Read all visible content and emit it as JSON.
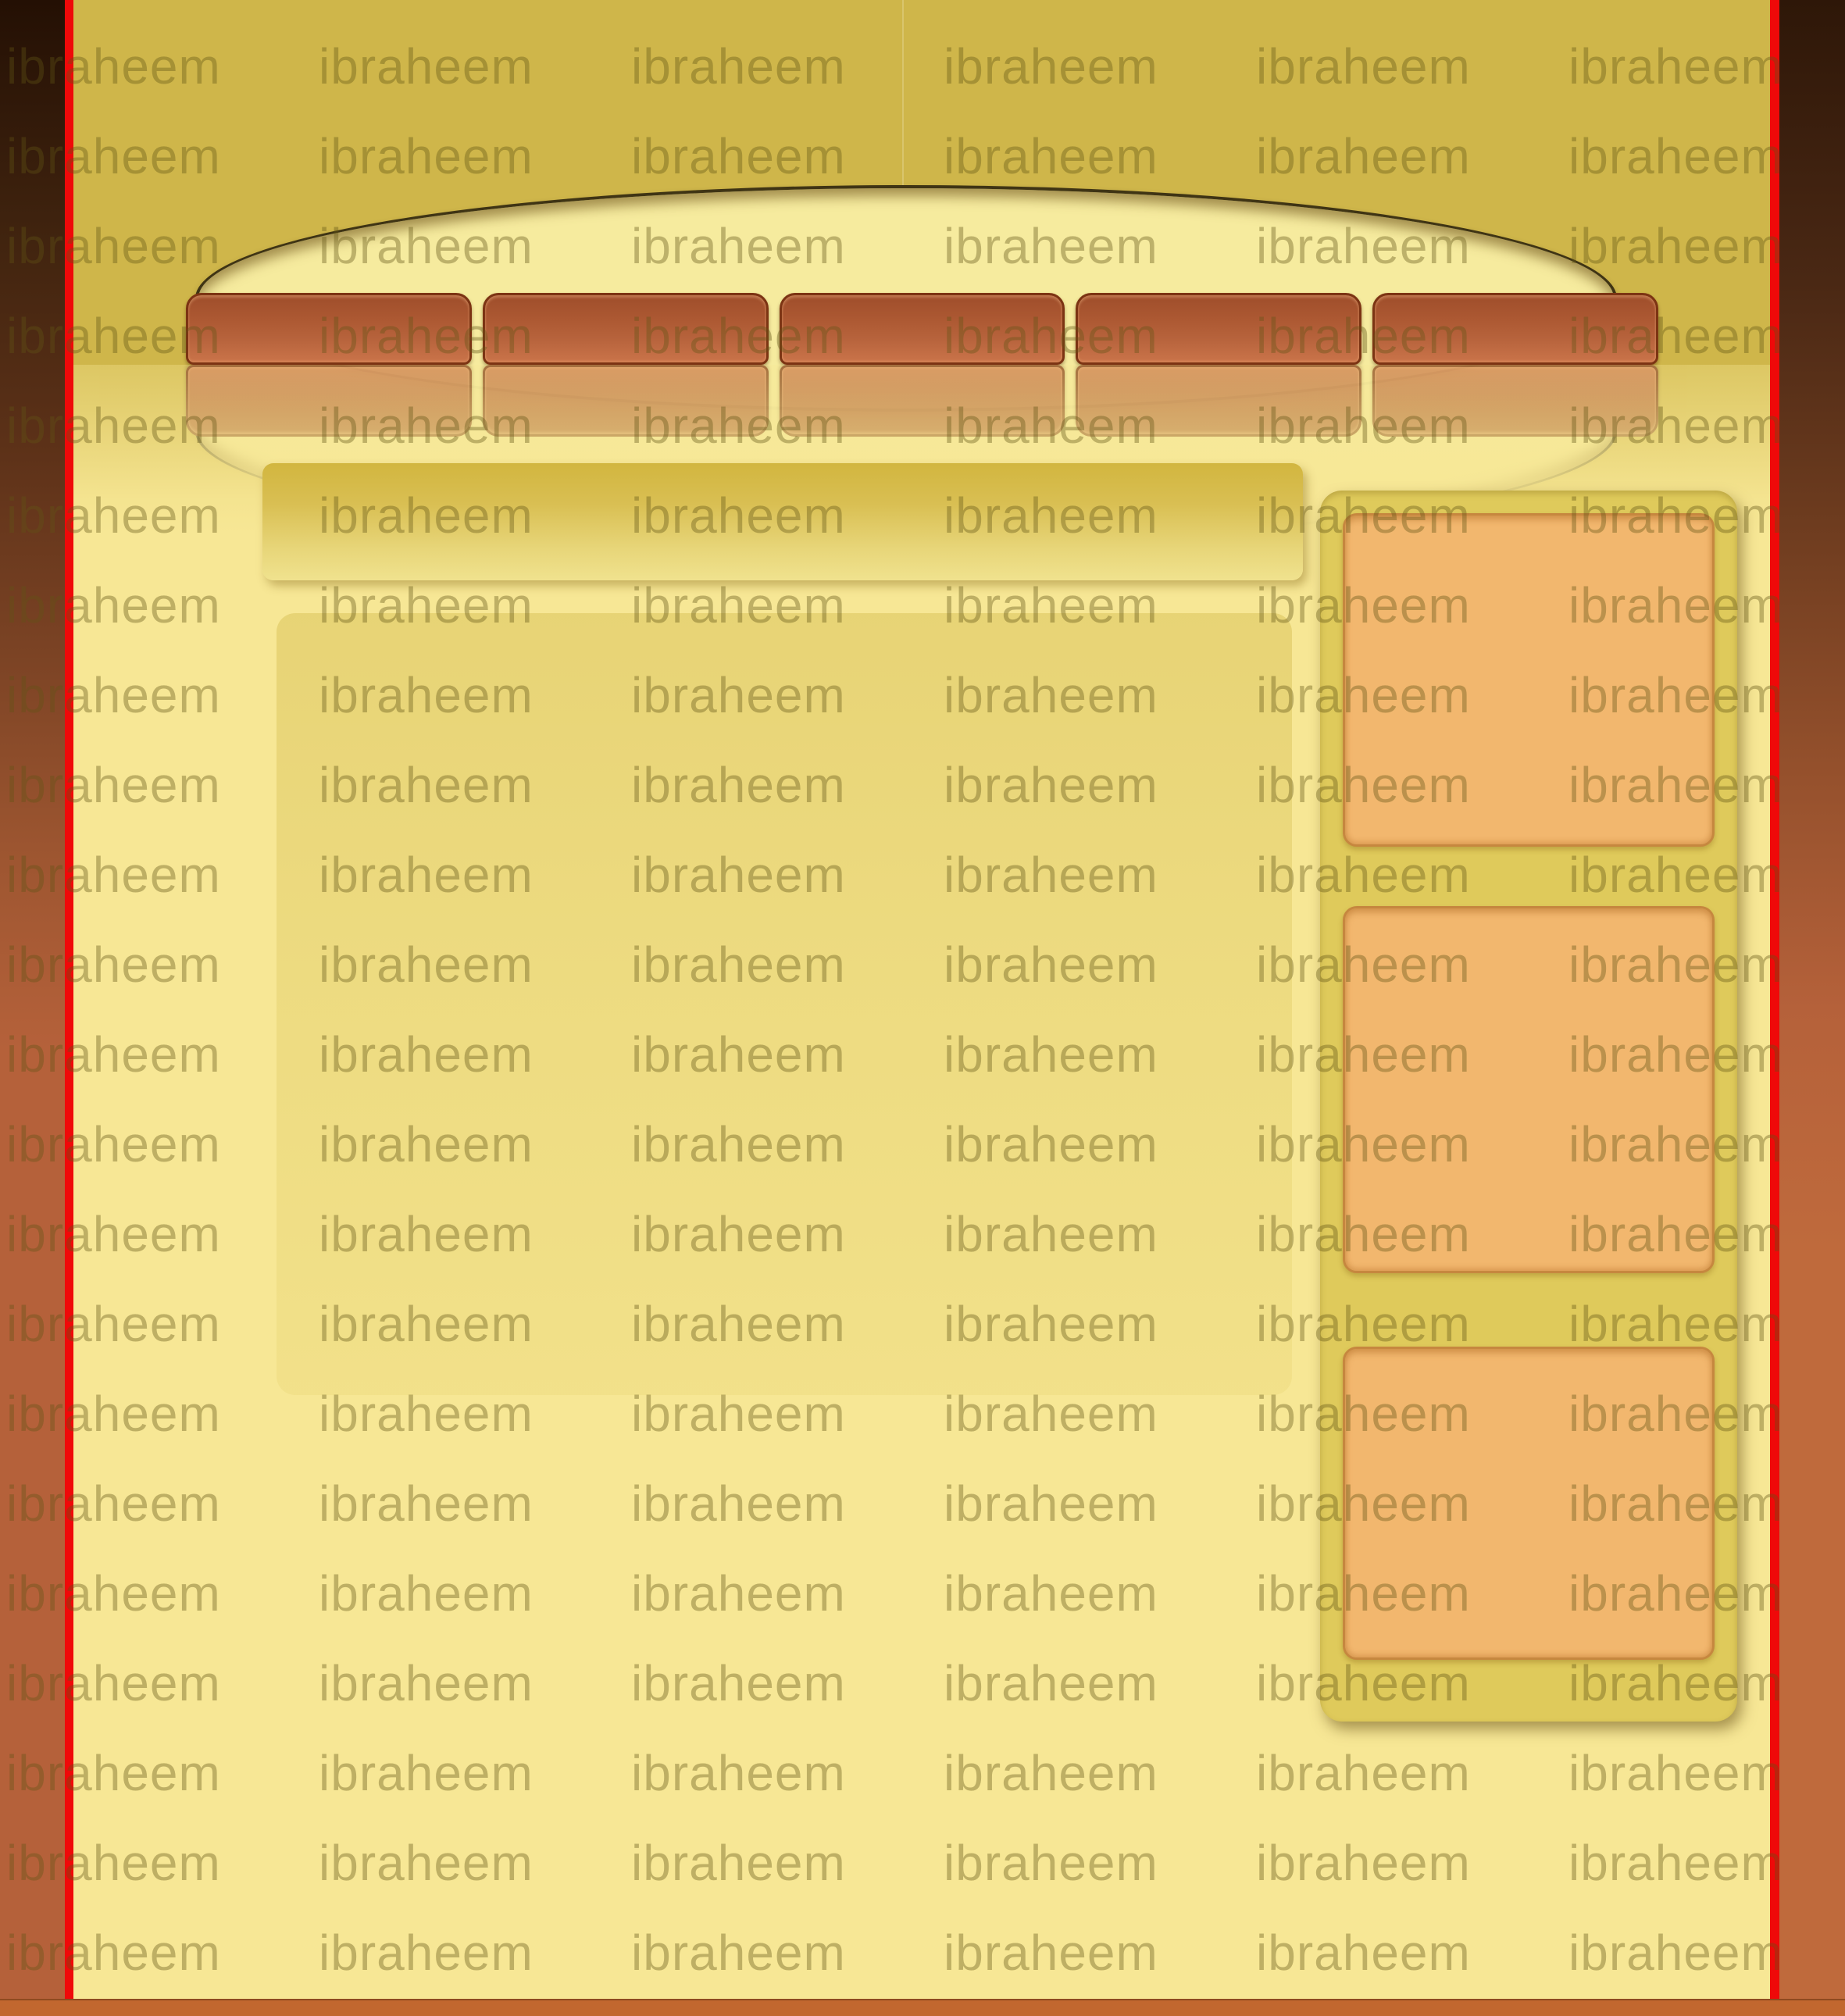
{
  "watermark": {
    "text": "ibraheem",
    "rows": 22,
    "cols": 6
  },
  "header": {
    "nav_buttons": [
      {
        "label": ""
      },
      {
        "label": ""
      },
      {
        "label": ""
      },
      {
        "label": ""
      },
      {
        "label": ""
      }
    ]
  },
  "banner": {
    "label": ""
  },
  "sidebar": {
    "boxes": [
      {
        "label": ""
      },
      {
        "label": ""
      },
      {
        "label": ""
      }
    ]
  },
  "footer": {
    "label": ""
  },
  "theme": {
    "page_bg": "#f7e795",
    "header_bg": "#cfb64a",
    "ellipse_fill": "#f6eb9e",
    "ellipse_stroke": "#3f3414",
    "nav_button_top": "#9f4e2b",
    "nav_button_bottom": "#ca744a",
    "nav_button_border": "#7c3413",
    "banner_top": "#d2b63f",
    "banner_bottom": "#f0e28e",
    "sidebar_bg": "#dfca5b",
    "sidebar_box_fill": "#f2b76e",
    "sidebar_box_border": "#c6873f",
    "border_strip_dark": "#241004",
    "border_strip_main": "#b5613a",
    "accent_red": "#ef0909",
    "footer_bg": "#c2672f",
    "watermark_color": "rgba(98,85,22,0.38)"
  }
}
